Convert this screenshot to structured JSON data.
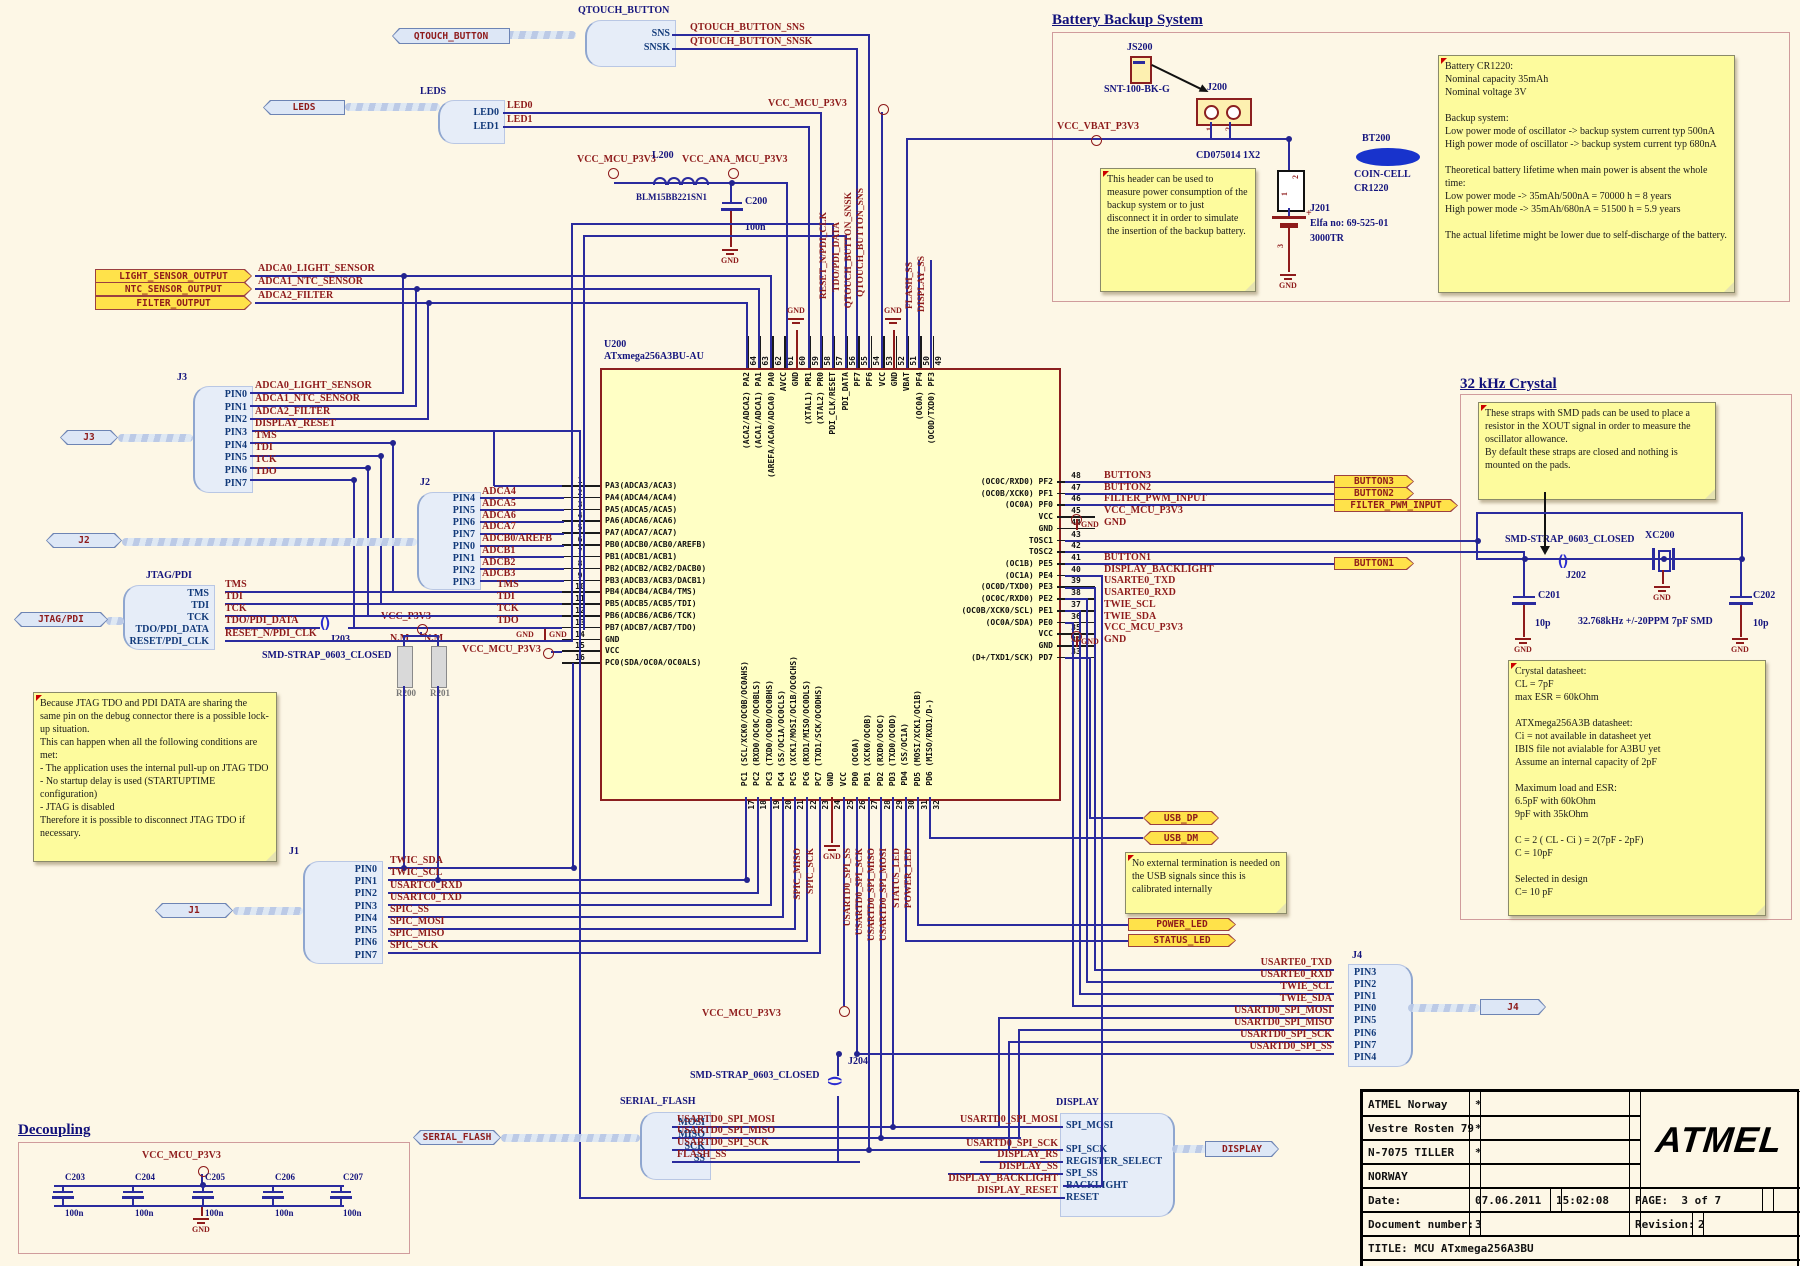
{
  "sections": {
    "battery": "Battery Backup System",
    "crystal": "32 kHz Crystal",
    "decoupling": "Decoupling"
  },
  "flags": {
    "qtouch": "QTOUCH_BUTTON",
    "leds": "LEDS",
    "j3": "J3",
    "j2": "J2",
    "jtag": "JTAG/PDI",
    "j1": "J1",
    "j4": "J4",
    "serial_flash": "SERIAL_FLASH",
    "display": "DISPLAY",
    "light": "LIGHT_SENSOR_OUTPUT",
    "ntc": "NTC_SENSOR_OUTPUT",
    "filter": "FILTER_OUTPUT",
    "button3": "BUTTON3",
    "button2": "BUTTON2",
    "filter_pwm": "FILTER_PWM_INPUT",
    "button1": "BUTTON1",
    "usb_dp": "USB_DP",
    "usb_dm": "USB_DM",
    "power_led": "POWER_LED",
    "status_led": "STATUS_LED"
  },
  "harness": {
    "qtouch": {
      "title": "QTOUCH_BUTTON",
      "pins": [
        "SNS",
        "SNSK"
      ]
    },
    "leds": {
      "title": "LEDS",
      "pins": [
        "LED0",
        "LED1"
      ]
    },
    "j3": {
      "label": "J3",
      "pins": [
        "PIN0",
        "PIN1",
        "PIN2",
        "PIN3",
        "PIN4",
        "PIN5",
        "PIN6",
        "PIN7"
      ]
    },
    "j2": {
      "label": "J2",
      "pins": [
        "PIN4",
        "PIN5",
        "PIN6",
        "PIN7",
        "PIN0",
        "PIN1",
        "PIN2",
        "PIN3"
      ]
    },
    "jtag": {
      "title": "JTAG/PDI",
      "pins": [
        "TMS",
        "TDI",
        "TCK",
        "TDO/PDI_DATA",
        "RESET/PDI_CLK"
      ]
    },
    "j1": {
      "label": "J1",
      "pins": [
        "PIN0",
        "PIN1",
        "PIN2",
        "PIN3",
        "PIN4",
        "PIN5",
        "PIN6",
        "PIN7"
      ]
    },
    "j4": {
      "label": "J4",
      "pins": [
        "PIN3",
        "PIN2",
        "PIN1",
        "PIN0",
        "PIN5",
        "PIN6",
        "PIN7",
        "PIN4"
      ]
    },
    "serial_flash": {
      "title": "SERIAL_FLASH",
      "pins": [
        "MOSI",
        "MISO",
        "SCK",
        "SS"
      ]
    },
    "display": {
      "title": "DISPLAY",
      "pins": [
        "SPI_MOSI",
        "",
        "SPI_SCK",
        "REGISTER_SELECT",
        "SPI_SS",
        "BACKLIGHT",
        "RESET"
      ]
    }
  },
  "nets": {
    "qtouch": [
      "QTOUCH_BUTTON_SNS",
      "QTOUCH_BUTTON_SNSK"
    ],
    "leds": [
      "LED0",
      "LED1"
    ],
    "sensors": [
      "ADCA0_LIGHT_SENSOR",
      "ADCA1_NTC_SENSOR",
      "ADCA2_FILTER"
    ],
    "j3": [
      "ADCA0_LIGHT_SENSOR",
      "ADCA1_NTC_SENSOR",
      "ADCA2_FILTER",
      "DISPLAY_RESET",
      "TMS",
      "TDI",
      "TCK",
      "TDO"
    ],
    "j2": [
      "ADCA4",
      "ADCA5",
      "ADCA6",
      "ADCA7",
      "ADCB0/AREFB",
      "ADCB1",
      "ADCB2",
      "ADCB3"
    ],
    "jtag": [
      "TMS",
      "TDI",
      "TCK",
      "TDO/PDI_DATA",
      "RESET_N/PDI_CLK"
    ],
    "jtag_mcu": [
      "TMS",
      "TDI",
      "TCK",
      "TDO"
    ],
    "j1": [
      "TWIC_SDA",
      "TWIC_SCL",
      "USARTC0_RXD",
      "USARTC0_TXD",
      "SPIC_SS",
      "SPIC_MOSI",
      "SPIC_MISO",
      "SPIC_SCK"
    ],
    "top_rot": [
      "RESET_N/PDI_CLK",
      "TDO/PDI_DATA",
      "QTOUCH_BUTTON_SNSK",
      "QTOUCH_BUTTON_SNS",
      "FLASH_SS",
      "DISPLAY_SS"
    ],
    "bottom_rot": [
      "SPIC_MISO",
      "SPIC_SCK",
      "USARTD0_SPI_SS",
      "USARTD0_SPI_SCK",
      "USARTD0_SPI_MISO",
      "USARTD0_SPI_MOSI",
      "STATUS_LED",
      "POWER_LED"
    ],
    "j4": [
      "USARTE0_TXD",
      "USARTE0_RXD",
      "TWIE_SCL",
      "TWIE_SDA",
      "USARTD0_SPI_MOSI",
      "USARTD0_SPI_MISO",
      "USARTD0_SPI_SCK",
      "USARTD0_SPI_SS"
    ],
    "sf": [
      "USARTD0_SPI_MOSI",
      "USARTD0_SPI_MISO",
      "USARTD0_SPI_SCK",
      "FLASH_SS"
    ],
    "display_in": [
      "USARTD0_SPI_MOSI",
      "USARTD0_SPI_SCK",
      "DISPLAY_RS",
      "DISPLAY_SS",
      "DISPLAY_BACKLIGHT",
      "DISPLAY_RESET"
    ]
  },
  "power": {
    "vcc_mcu": "VCC_MCU_P3V3",
    "vcc_ana": "VCC_ANA_MCU_P3V3",
    "vcc_vbat": "VCC_VBAT_P3V3",
    "vcc_p3v3": "VCC_P3V3",
    "gnd": "GND"
  },
  "mcu": {
    "ref": "U200",
    "part": "ATxmega256A3BU-AU",
    "left_pins": [
      {
        "n": "1",
        "name": "PA3(ADCA3/ACA3)"
      },
      {
        "n": "2",
        "name": "PA4(ADCA4/ACA4)"
      },
      {
        "n": "3",
        "name": "PA5(ADCA5/ACA5)"
      },
      {
        "n": "4",
        "name": "PA6(ADCA6/ACA6)"
      },
      {
        "n": "5",
        "name": "PA7(ADCA7/ACA7)"
      },
      {
        "n": "6",
        "name": "PB0(ADCB0/ACB0/AREFB)"
      },
      {
        "n": "7",
        "name": "PB1(ADCB1/ACB1)"
      },
      {
        "n": "8",
        "name": "PB2(ADCB2/ACB2/DACB0)"
      },
      {
        "n": "9",
        "name": "PB3(ADCB3/ACB3/DACB1)"
      },
      {
        "n": "10",
        "name": "PB4(ADCB4/ACB4/TMS)"
      },
      {
        "n": "11",
        "name": "PB5(ADCB5/ACB5/TDI)"
      },
      {
        "n": "12",
        "name": "PB6(ADCB6/ACB6/TCK)"
      },
      {
        "n": "13",
        "name": "PB7(ADCB7/ACB7/TDO)"
      },
      {
        "n": "14",
        "name": "GND"
      },
      {
        "n": "15",
        "name": "VCC"
      },
      {
        "n": "16",
        "name": "PC0(SDA/OC0A/OC0ALS)"
      }
    ],
    "top_pins": [
      {
        "n": "64",
        "name": "(ACA2/ADCA2) PA2"
      },
      {
        "n": "63",
        "name": "(ACA1/ADCA1) PA1"
      },
      {
        "n": "62",
        "name": "(AREFA/ACA0/ADCA0) PA0"
      },
      {
        "n": "61",
        "name": "AVCC"
      },
      {
        "n": "60",
        "name": "GND"
      },
      {
        "n": "59",
        "name": "(XTAL1) PR1"
      },
      {
        "n": "58",
        "name": "(XTAL2) PR0"
      },
      {
        "n": "57",
        "name": "PDI_CLK/RESET"
      },
      {
        "n": "56",
        "name": "PDI_DATA"
      },
      {
        "n": "55",
        "name": "PF7"
      },
      {
        "n": "54",
        "name": "PF6"
      },
      {
        "n": "53",
        "name": "VCC"
      },
      {
        "n": "52",
        "name": "GND"
      },
      {
        "n": "51",
        "name": "VBAT"
      },
      {
        "n": "50",
        "name": "(OC0A) PF4"
      },
      {
        "n": "49",
        "name": "(OC0D/TXD0) PF3"
      }
    ],
    "right_pins": [
      {
        "n": "48",
        "name": "(OC0C/RXD0) PF2",
        "net": "BUTTON3"
      },
      {
        "n": "47",
        "name": "(OC0B/XCK0) PF1",
        "net": "BUTTON2"
      },
      {
        "n": "46",
        "name": "(OC0A) PF0",
        "net": "FILTER_PWM_INPUT"
      },
      {
        "n": "45",
        "name": "VCC",
        "net": "VCC_MCU_P3V3"
      },
      {
        "n": "44",
        "name": "GND",
        "net": "GND"
      },
      {
        "n": "43",
        "name": "TOSC1",
        "net": ""
      },
      {
        "n": "42",
        "name": "TOSC2",
        "net": ""
      },
      {
        "n": "41",
        "name": "(OC1B) PE5",
        "net": "BUTTON1"
      },
      {
        "n": "40",
        "name": "(OC1A) PE4",
        "net": "DISPLAY_BACKLIGHT"
      },
      {
        "n": "39",
        "name": "(OC0D/TXD0) PE3",
        "net": "USARTE0_TXD"
      },
      {
        "n": "38",
        "name": "(OC0C/RXD0) PE2",
        "net": "USARTE0_RXD"
      },
      {
        "n": "37",
        "name": "(OC0B/XCK0/SCL) PE1",
        "net": "TWIE_SCL"
      },
      {
        "n": "36",
        "name": "(OC0A/SDA) PE0",
        "net": "TWIE_SDA"
      },
      {
        "n": "35",
        "name": "VCC",
        "net": "VCC_MCU_P3V3"
      },
      {
        "n": "34",
        "name": "GND",
        "net": "GND"
      },
      {
        "n": "33",
        "name": "(D+/TXD1/SCK) PD7",
        "net": ""
      }
    ],
    "bottom_pins": [
      {
        "n": "17",
        "name": "PC1 (SCL/XCK0/OC0B/OC0AHS)"
      },
      {
        "n": "18",
        "name": "PC2 (RXD0/OC0C/OC0BLS)"
      },
      {
        "n": "19",
        "name": "PC3 (TXD0/OC0D/OC0BHS)"
      },
      {
        "n": "20",
        "name": "PC4 (SS/OC1A/OC0CLS)"
      },
      {
        "n": "21",
        "name": "PC5 (XCK1/MOSI/OC1B/OC0CHS)"
      },
      {
        "n": "22",
        "name": "PC6 (RXD1/MISO/OC0DLS)"
      },
      {
        "n": "23",
        "name": "PC7 (TXD1/SCK/OC0DHS)"
      },
      {
        "n": "24",
        "name": "GND"
      },
      {
        "n": "25",
        "name": "VCC"
      },
      {
        "n": "26",
        "name": "PD0 (OC0A)"
      },
      {
        "n": "27",
        "name": "PD1 (XCK0/OC0B)"
      },
      {
        "n": "28",
        "name": "PD2 (RXD0/OC0C)"
      },
      {
        "n": "29",
        "name": "PD3 (TXD0/OC0D)"
      },
      {
        "n": "30",
        "name": "PD4 (SS/OC1A)"
      },
      {
        "n": "31",
        "name": "PD5 (MOSI/XCK1/OC1B)"
      },
      {
        "n": "32",
        "name": "PD6 (MISO/RXD1/D-)"
      }
    ]
  },
  "components": {
    "l200": {
      "ref": "L200",
      "part": "BLM15BB221SN1"
    },
    "c200": {
      "ref": "C200",
      "val": "100n"
    },
    "j203": {
      "ref": "J203",
      "part": "SMD-STRAP_0603_CLOSED"
    },
    "j202": {
      "ref": "J202",
      "part": "SMD-STRAP_0603_CLOSED"
    },
    "j204": {
      "ref": "J204",
      "part": "SMD-STRAP_0603_CLOSED"
    },
    "xc200": {
      "ref": "XC200",
      "spec": "32.768kHz +/-20PPM 7pF  SMD"
    },
    "c201": {
      "ref": "C201",
      "val": "10p"
    },
    "c202": {
      "ref": "C202",
      "val": "10p"
    },
    "r200": {
      "ref": "R200",
      "nm": "N.M"
    },
    "r201": {
      "ref": "R201",
      "nm": "N.M"
    },
    "caps_decoupling": [
      {
        "ref": "C203",
        "val": "100n"
      },
      {
        "ref": "C204",
        "val": "100n"
      },
      {
        "ref": "C205",
        "val": "100n"
      },
      {
        "ref": "C206",
        "val": "100n"
      },
      {
        "ref": "C207",
        "val": "100n"
      }
    ]
  },
  "battery": {
    "js200": "JS200",
    "js200_part": "SNT-100-BK-G",
    "j200": "J200",
    "j200_part": "CD075014 1X2",
    "j201": "J201",
    "j201_elfa": "Elfa no: 69-525-01",
    "j201_part": "3000TR",
    "bt200": "BT200",
    "bt200_type": "COIN-CELL",
    "bt200_part": "CR1220",
    "pin1": "1",
    "pin2": "2",
    "pin3": "3",
    "plus": "+",
    "note_header": "This header can be used to measure power consumption of the backup system or to just disconnect it in order to simulate the insertion of the backup battery.",
    "note_battery": "Battery CR1220:\nNominal capacity 35mAh\nNominal voltage 3V\n\nBackup system:\nLow power mode of oscillator -> backup system current typ 500nA\nHigh power mode of oscillator -> backup system current typ 680nA\n\nTheoretical battery lifetime when main power is absent the whole time:\nLow power mode -> 35mAh/500nA = 70000 h = 8 years\nHigh power mode -> 35mAh/680nA = 51500 h = 5.9 years\n\nThe actual lifetime might be lower due to self-discharge of the battery."
  },
  "notes": {
    "jtag": "Because JTAG TDO and PDI DATA are sharing the same pin on the debug connector there is a possible lock-up situation.\nThis can happen when all the following conditions are met:\n- The application uses the internal pull-up on JTAG TDO\n- No startup delay is used (STARTUPTIME configuration)\n- JTAG is disabled\nTherefore it is possible to disconnect JTAG TDO if necessary.",
    "usb": "No external termination is needed on the USB signals since this is calibrated internally",
    "crystal_straps": "These straps with SMD pads can be used to place a resistor in the XOUT signal in order to measure the oscillator allowance.\nBy default these straps are closed and nothing is mounted on the pads.",
    "crystal_datasheet": "Crystal datasheet:\nCL = 7pF\nmax ESR = 60kOhm\n\nATXmega256A3B datasheet:\nCi = not available in datasheet yet\nIBIS file not avialable for A3BU yet\nAssume an internal capacity of 2pF\n\nMaximum load and ESR:\n6.5pF with 60kOhm\n9pF with 35kOhm\n\nC = 2 ( CL - Ci ) = 2(7pF - 2pF)\nC = 10pF\n\nSelected in design\nC= 10 pF"
  },
  "titleblock": {
    "company": "ATMEL Norway",
    "addr1": "Vestre Rosten 79",
    "addr2": "N-7075 TILLER",
    "addr3": "NORWAY",
    "star": "*",
    "date_label": "Date:",
    "date": "07.06.2011",
    "time": "15:02:08",
    "page_label": "PAGE:",
    "page": "3  of  7",
    "doc_label": "Document number:",
    "doc": "3",
    "rev_label": "Revision:",
    "rev": "2",
    "title": "TITLE: MCU ATxmega256A3BU",
    "file": "XMEGA-A3BU_XPLAINED_MCU.SchDoc",
    "logo": "ATMEL"
  }
}
